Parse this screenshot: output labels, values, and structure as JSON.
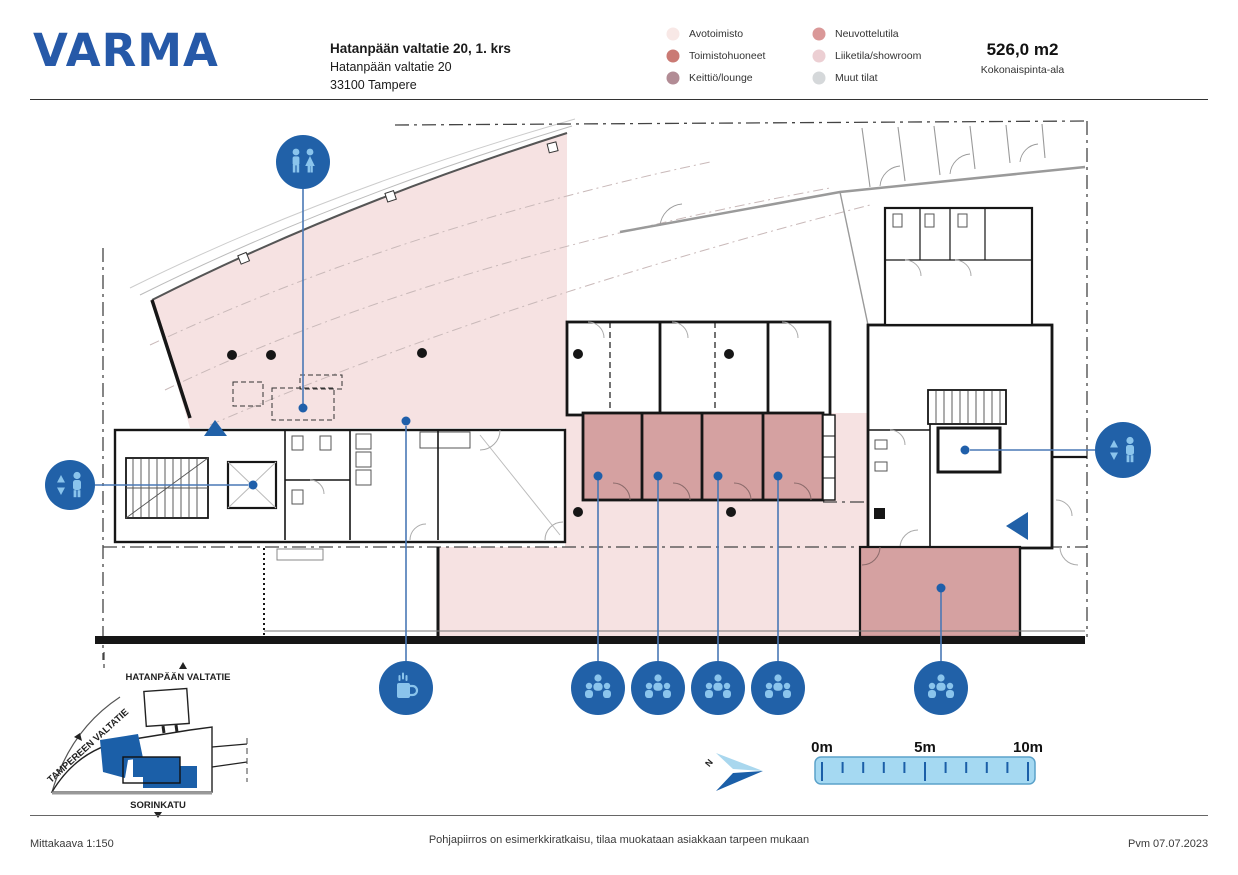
{
  "header": {
    "logo": "VARMA",
    "building_title": "Hatanpään valtatie 20, 1. krs",
    "address_line1": "Hatanpään valtatie 20",
    "address_line2": "33100 Tampere",
    "total_area_value": "526,0 m2",
    "total_area_label": "Kokonaispinta-ala"
  },
  "legend": {
    "items": [
      {
        "label": "Avotoimisto",
        "color": "#f8e8e6"
      },
      {
        "label": "Toimistohuoneet",
        "color": "#ca7a74"
      },
      {
        "label": "Keittiö/lounge",
        "color": "#b28c95"
      },
      {
        "label": "Neuvottelutila",
        "color": "#da9898"
      },
      {
        "label": "Liiketila/showroom",
        "color": "#eccfd3"
      },
      {
        "label": "Muut tilat",
        "color": "#d5d8da"
      }
    ]
  },
  "icons": {
    "wc-icon": "male and female figures in blue circle",
    "elevator-icon": "person with up/down arrows in blue circle",
    "coffee-icon": "steaming mug in blue circle",
    "meeting-icon": "group of three people in blue circle",
    "entrance-icon": "solid blue triangle arrow",
    "north-arrow-icon": "two-tone blue compass arrow"
  },
  "inset_map": {
    "street_top": "HATANPÄÄN VALTATIE",
    "street_left": "TAMPEREEN VALTATIE",
    "street_bottom": "SORINKATU"
  },
  "scale_bar": {
    "label_0": "0m",
    "label_5": "5m",
    "label_10": "10m"
  },
  "compass": {
    "label": "N"
  },
  "footer": {
    "scale_text": "Mittakaava 1:150",
    "disclaimer": "Pohjapiirros on esimerkkiratkaisu, tilaa muokataan asiakkaan tarpeen mukaan",
    "date_text": "Pvm 07.07.2023"
  },
  "colors": {
    "brand_blue": "#2659a8",
    "marker_blue": "#2161a8",
    "glyph_light_blue": "#8ac4ec",
    "leader_line": "#4a78b5",
    "open_area_pink": "#f6e2e2",
    "room_salmon": "#d5a1a1",
    "scalebar_fill": "#a5d9f2",
    "scalebar_stroke": "#5ba2ca",
    "wall": "#161616"
  }
}
